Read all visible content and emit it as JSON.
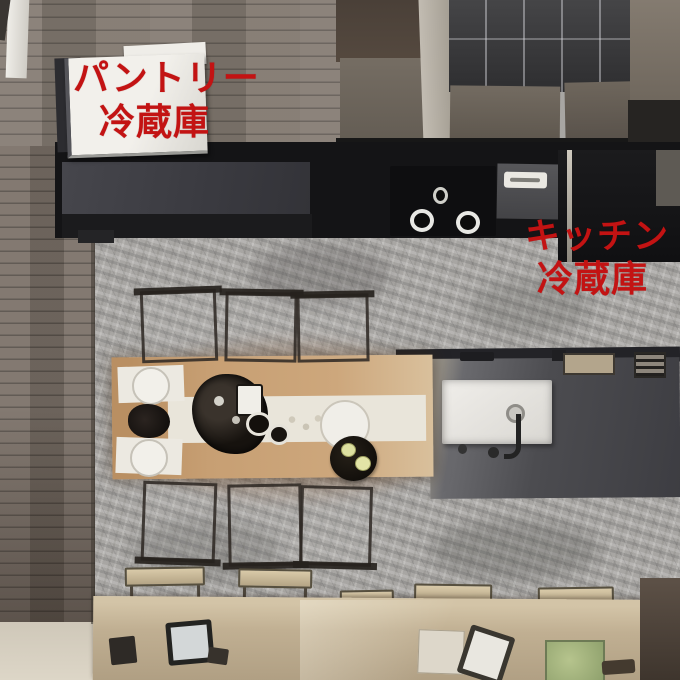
{
  "annotations": {
    "pantry": {
      "title": "パントリー",
      "subtitle": "冷蔵庫"
    },
    "kitchen": {
      "title": "キッチン",
      "subtitle": "冷蔵庫"
    }
  },
  "palette": {
    "annotation_red": "#c31313",
    "stone_floor_gray": "#a8a6a3",
    "wood_floor_brown": "#7b7168",
    "counter_charcoal": "#3f3f44",
    "cooktop_black": "#0e0e10",
    "pantry_fridge_white": "#eceae5",
    "kitchen_fridge_black": "#151517",
    "dining_table_tan": "#c69e72",
    "table_runner_white": "#e9e5da",
    "bottom_counter_tan": "#bfae92",
    "green_mat": "#9db07c",
    "plaid_bedding_dark": "#3a3a3c"
  }
}
